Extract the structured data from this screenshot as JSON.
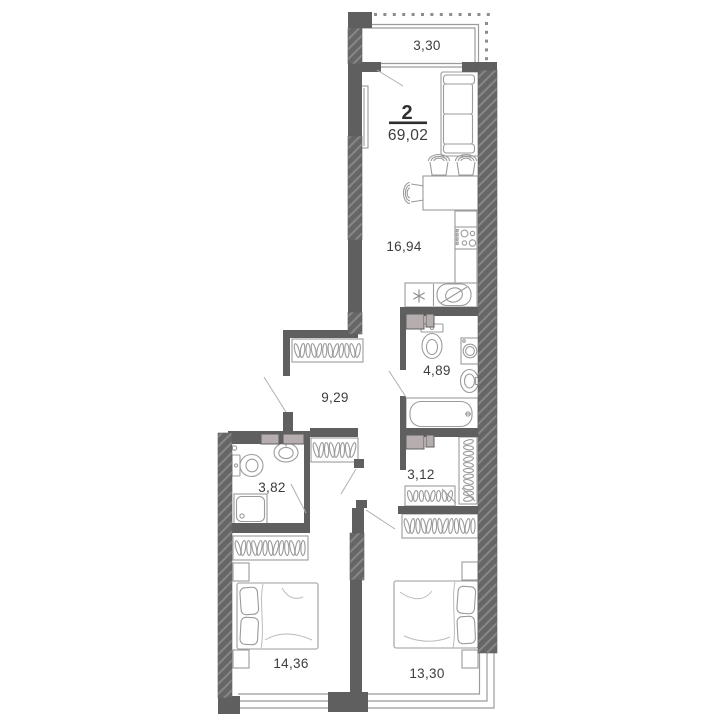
{
  "plan": {
    "apartment": {
      "rooms_count": "2",
      "total_area": "69,02"
    },
    "rooms": [
      {
        "id": "balcony",
        "area": "3,30"
      },
      {
        "id": "kitchen-living-room",
        "area": "16,94"
      },
      {
        "id": "bathroom",
        "area": "4,89"
      },
      {
        "id": "hallway",
        "area": "9,29"
      },
      {
        "id": "toilet-room",
        "area": "3,82"
      },
      {
        "id": "wardrobe-closet",
        "area": "3,12"
      },
      {
        "id": "bedroom-1",
        "area": "14,36"
      },
      {
        "id": "bedroom-2",
        "area": "13,30"
      }
    ],
    "icons": [
      "fridge-snowflake-icon",
      "hanger-rail-icon",
      "vent-shaft-block"
    ],
    "colors": {
      "wall": "#5f5f5f",
      "hatch_line": "#878787",
      "vent_shaft": "#b6aeae",
      "furniture_line": "#9b9b9b",
      "door_swing": "#b0b0b0",
      "dotted_outline": "#8d8d8d",
      "label_text": "#3d3d3d",
      "header_dark": "#2e2e2e"
    }
  }
}
